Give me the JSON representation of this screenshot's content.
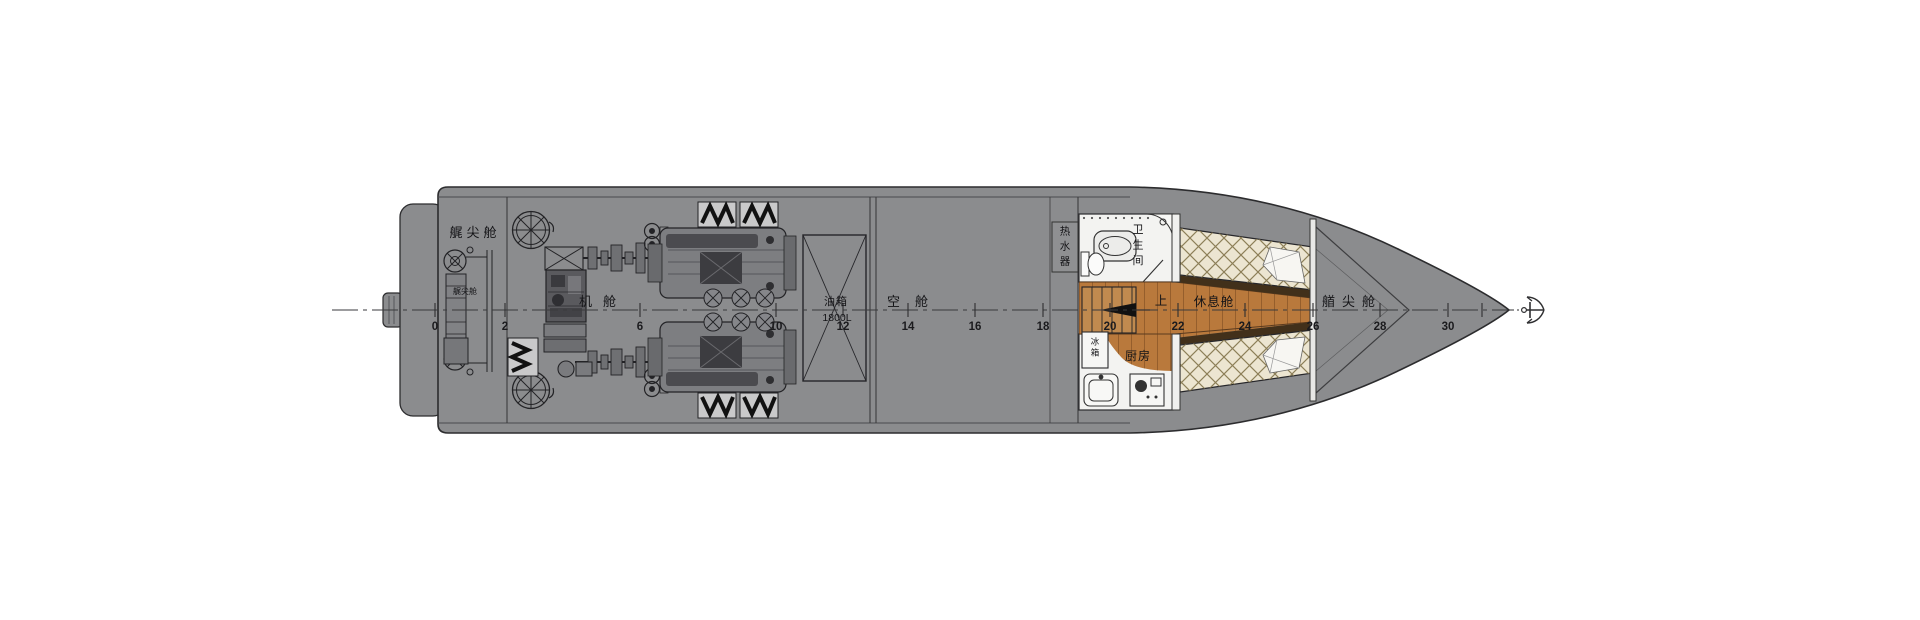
{
  "drawing": {
    "type": "boat-general-arrangement-plan",
    "colors": {
      "hull_gray": "#8b8c8e",
      "outline": "#2c2c2e",
      "wood_floor": "#b9793c",
      "wood_line": "#8a5526",
      "mattress_cream": "#ece5d1",
      "quilt_line": "#8d7f58",
      "room_white": "#f3f3f1",
      "bed_base_dark": "#42301a",
      "stripe_black": "#111111"
    },
    "icons": {
      "bow_marker": "anchor-icon",
      "deck_hatches": "round-hatch-icon",
      "hazard_boxes": "striped-chevron-box"
    },
    "labels": [
      {
        "id": "stern-peak-cabin",
        "text": "艉尖舱",
        "x": 475,
        "y": 237,
        "size": 13,
        "ls": 4
      },
      {
        "id": "stern-peak-small",
        "text": "艉尖舱",
        "x": 465,
        "y": 294,
        "size": 8,
        "ls": 0
      },
      {
        "id": "engine-room",
        "text": "机舱",
        "x": 603,
        "y": 306,
        "size": 13,
        "ls": 11
      },
      {
        "id": "fuel-tank",
        "text": "油箱",
        "x": 836,
        "y": 305,
        "size": 11,
        "ls": 1
      },
      {
        "id": "fuel-capacity",
        "text": "1800L",
        "x": 837,
        "y": 321,
        "size": 10.5,
        "ls": 0
      },
      {
        "id": "void-space",
        "text": "空舱",
        "x": 915,
        "y": 306,
        "size": 13,
        "ls": 15
      },
      {
        "id": "rest-cabin",
        "text": "休息舱",
        "x": 1214,
        "y": 306,
        "size": 12.5,
        "ls": 1
      },
      {
        "id": "bow-peak-cabin",
        "text": "艏尖舱",
        "x": 1352,
        "y": 306,
        "size": 13,
        "ls": 7
      },
      {
        "id": "stairs-up",
        "text": "上",
        "x": 1161,
        "y": 305,
        "size": 12.5,
        "ls": 0
      },
      {
        "id": "kitchen",
        "text": "厨房",
        "x": 1138,
        "y": 360,
        "size": 12,
        "ls": 1
      },
      {
        "id": "bathroom",
        "text": "卫生间",
        "x": 1138,
        "y": 222,
        "size": 11,
        "vertical": true,
        "dy": 15.5
      },
      {
        "id": "water-heater",
        "text": "热水器",
        "x": 1065,
        "y": 224,
        "size": 10.5,
        "vertical": true,
        "dy": 15
      },
      {
        "id": "fridge",
        "text": "冰箱",
        "x": 1095,
        "y": 336,
        "size": 8.5,
        "vertical": true,
        "dy": 11
      }
    ],
    "frames": [
      {
        "n": "0",
        "x": 435
      },
      {
        "n": "2",
        "x": 505
      },
      {
        "n": "6",
        "x": 640
      },
      {
        "n": "10",
        "x": 776
      },
      {
        "n": "12",
        "x": 843
      },
      {
        "n": "14",
        "x": 908
      },
      {
        "n": "16",
        "x": 975
      },
      {
        "n": "18",
        "x": 1043
      },
      {
        "n": "20",
        "x": 1110
      },
      {
        "n": "22",
        "x": 1178
      },
      {
        "n": "24",
        "x": 1245
      },
      {
        "n": "26",
        "x": 1313
      },
      {
        "n": "28",
        "x": 1380
      },
      {
        "n": "30",
        "x": 1448
      },
      {
        "n": "",
        "x": 1482
      }
    ]
  }
}
